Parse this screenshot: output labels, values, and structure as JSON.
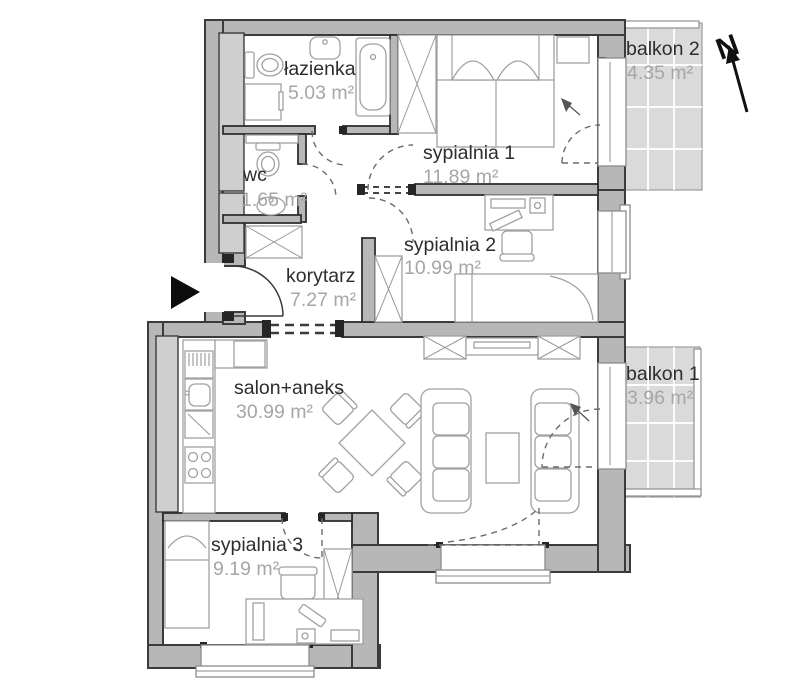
{
  "rooms": {
    "lazienka": {
      "name": "łazienka",
      "area": "5.03 m²"
    },
    "wc": {
      "name": "wc",
      "area": "1.65 m²"
    },
    "sypialnia1": {
      "name": "sypialnia 1",
      "area": "11.89 m²"
    },
    "sypialnia2": {
      "name": "sypialnia 2",
      "area": "10.99 m²"
    },
    "korytarz": {
      "name": "korytarz",
      "area": "7.27 m²"
    },
    "salon": {
      "name": "salon+aneks",
      "area": "30.99 m²"
    },
    "sypialnia3": {
      "name": "sypialnia 3",
      "area": "9.19 m²"
    },
    "balkon1": {
      "name": "balkon 1",
      "area": "3.96 m²"
    },
    "balkon2": {
      "name": "balkon 2",
      "area": "4.35 m²"
    }
  },
  "compass": {
    "label": "N"
  },
  "colors": {
    "wall_fill": "#b7b7b7",
    "wall_line": "#3b3b3b",
    "shaft_fill": "#cfcfcf",
    "balcony_tile": "#dadada",
    "furniture_line": "#a0a0a0",
    "room_name_text": "#2d2d2d",
    "room_area_text": "#a6a6a6",
    "north_arrow": "#101010",
    "entrance_marker": "#0d0d0d"
  }
}
